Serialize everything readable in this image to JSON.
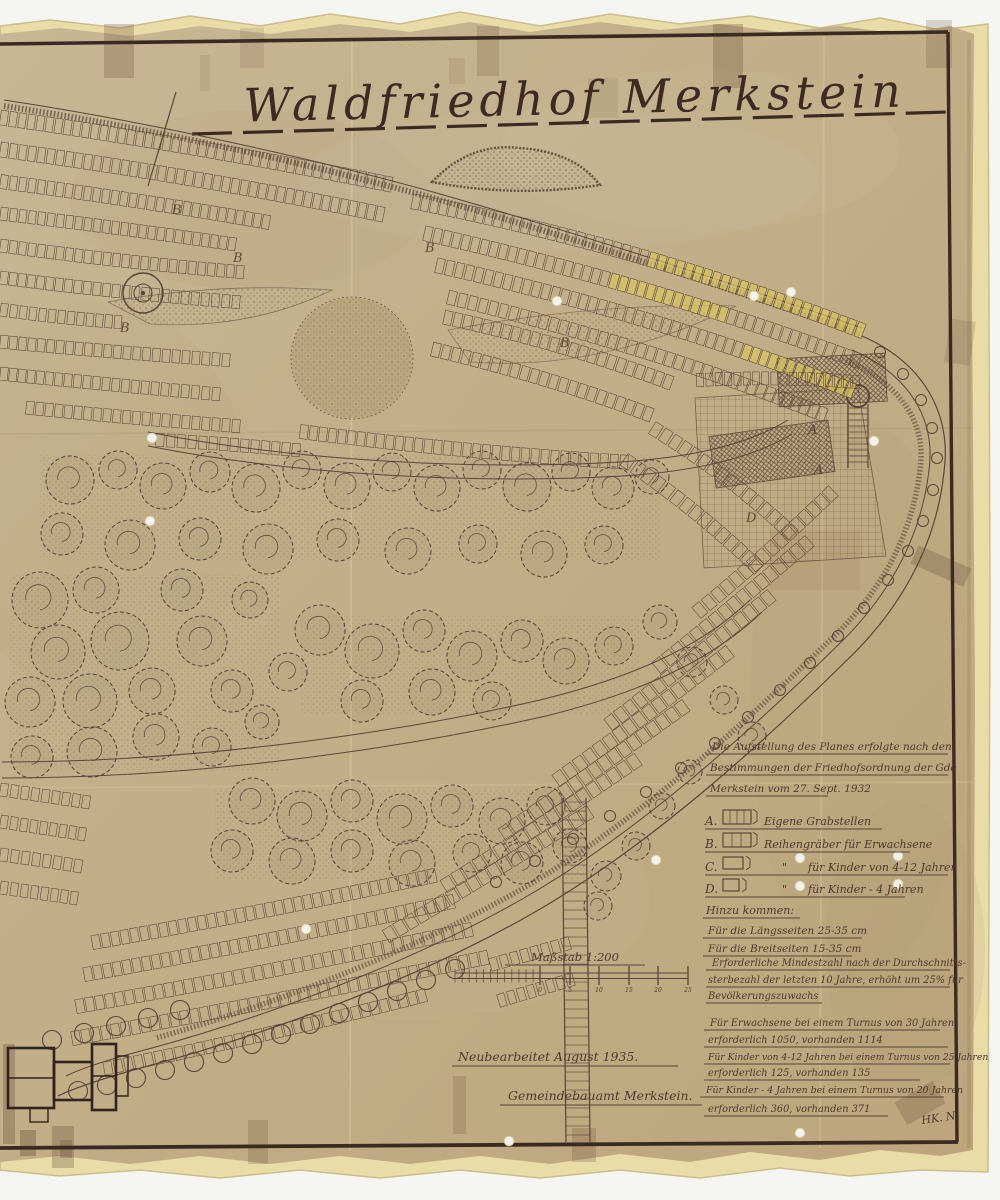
{
  "doc": {
    "title": "Waldfriedhof Merkstein",
    "ordinance_note": [
      "Die Aufstellung des Planes erfolgte nach den",
      "Bestimmungen der Friedhofsordnung der Gde",
      "Merkstein vom 27. Sept. 1932"
    ],
    "legend": {
      "items": [
        {
          "key": "A.",
          "label": "Eigene Grabstellen"
        },
        {
          "key": "B.",
          "label": "Reihengräber für Erwachsene"
        },
        {
          "key": "C.",
          "ditto": "\"",
          "label": "für Kinder von 4-12 Jahren"
        },
        {
          "key": "D.",
          "ditto": "\"",
          "label": "für Kinder - 4 Jahren"
        }
      ],
      "heading": "Hinzu kommen:",
      "additions": [
        "Für die Längsseiten 25-35 cm",
        "Für die Breitseiten 15-35 cm"
      ]
    },
    "capacity_note": [
      "Erforderliche Mindestzahl nach der Durchschnitts-",
      "sterbezahl der letzten 10 Jahre, erhöht um 25% für",
      "Bevölkerungszuwachs"
    ],
    "turnus_note": [
      "Für Erwachsene bei einem Turnus von 30 Jahren",
      "erforderlich 1050, vorhanden 1114",
      "Für Kinder von 4-12 Jahren bei einem Turnus von 25 Jahren",
      "erforderlich 125, vorhanden 135",
      "Für Kinder - 4 Jahren bei einem Turnus von 20 Jahren",
      "erforderlich 360, vorhanden 371"
    ],
    "scale": {
      "label": "Maßstab 1:200",
      "ticks": [
        "0",
        "5",
        "10",
        "15",
        "20",
        "25"
      ]
    },
    "revision": "Neubearbeitet August 1935.",
    "office": "Gemeindebauamt Merkstein.",
    "signature": "HK. N.",
    "section_markers": [
      {
        "label": "B",
        "x": 172,
        "y": 214
      },
      {
        "label": "B",
        "x": 233,
        "y": 262
      },
      {
        "label": "B",
        "x": 120,
        "y": 332
      },
      {
        "label": "B",
        "x": 425,
        "y": 252
      },
      {
        "label": "B",
        "x": 560,
        "y": 347
      },
      {
        "label": "A",
        "x": 808,
        "y": 434
      },
      {
        "label": "A",
        "x": 814,
        "y": 474
      },
      {
        "label": "D",
        "x": 746,
        "y": 522
      }
    ],
    "colors": {
      "map_paper": "#c3b08c",
      "backing_paper": "#e9dca6",
      "ink": "#4b362c",
      "frame": "#3c2a22",
      "plot_highlight": "#d8c45f"
    }
  }
}
